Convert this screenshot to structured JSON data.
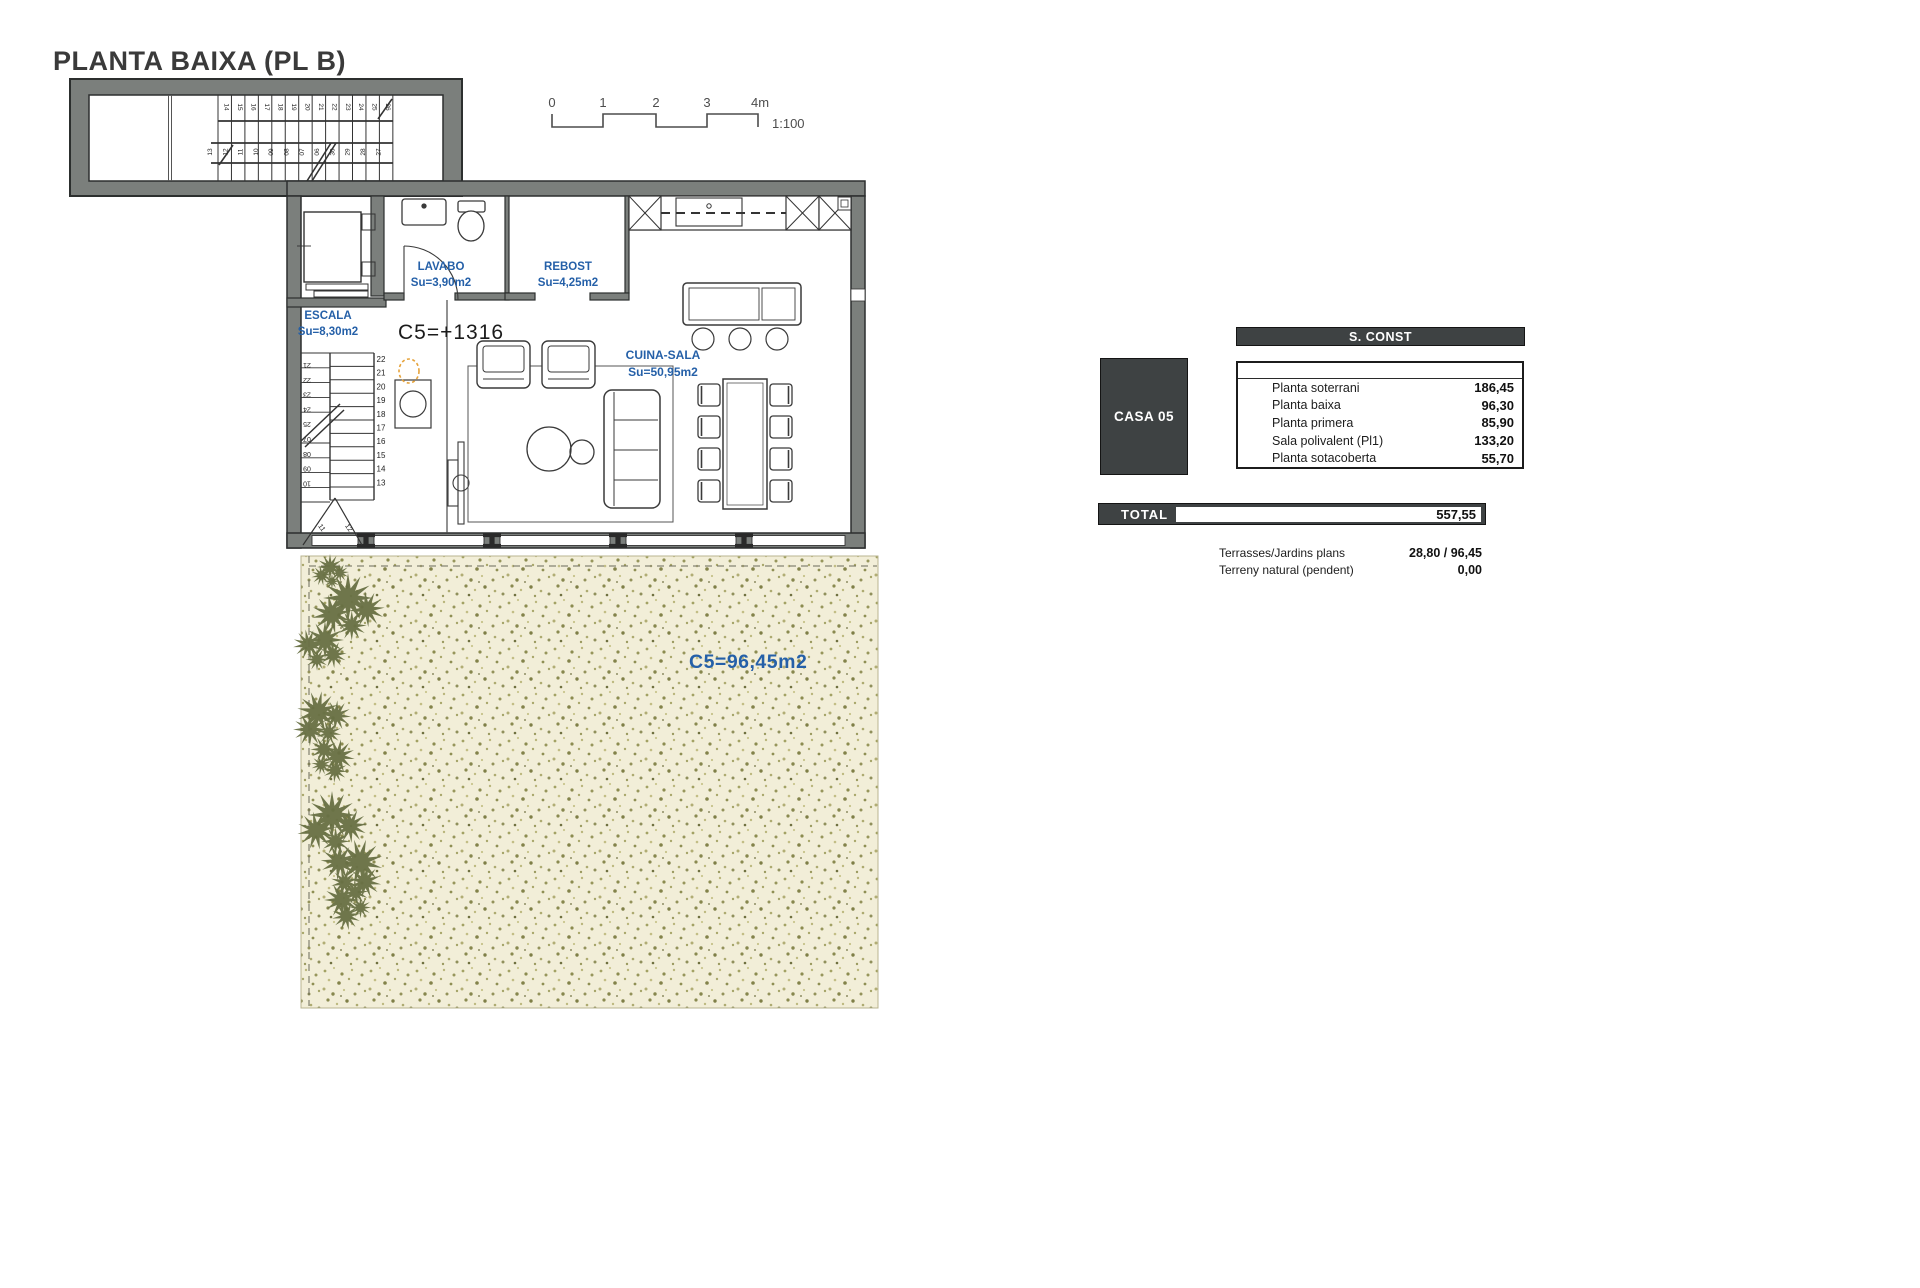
{
  "title": "PLANTA BAIXA (PL B)",
  "scale_bar": {
    "ticks": [
      "0",
      "1",
      "2",
      "3",
      "4m"
    ],
    "ratio_label": "1:100"
  },
  "plan": {
    "level_mark": "C5=+1316",
    "rooms": [
      {
        "name": "LAVABO",
        "area": "Su=3,90m2"
      },
      {
        "name": "REBOST",
        "area": "Su=4,25m2"
      },
      {
        "name": "ESCALA",
        "area": "Su=8,30m2"
      },
      {
        "name": "CUINA-SALA",
        "area": "Su=50,95m2"
      }
    ],
    "garden_area_label": "C5=96,45m2",
    "stair_numbers": {
      "wing_top": [
        "14",
        "15",
        "16",
        "17",
        "18",
        "19",
        "20",
        "21",
        "22",
        "23",
        "24",
        "25",
        "26"
      ],
      "wing_bottom": [
        "13",
        "12",
        "11",
        "10",
        "09",
        "08",
        "07",
        "06",
        "30",
        "29",
        "28",
        "27"
      ],
      "escala_right": [
        "22",
        "21",
        "20",
        "19",
        "18",
        "17",
        "16",
        "15",
        "14",
        "13"
      ],
      "escala_left": [
        "21",
        "22",
        "23",
        "24",
        "25",
        "07",
        "08",
        "09",
        "10"
      ],
      "escala_winders": [
        "11",
        "12"
      ]
    }
  },
  "summary": {
    "casa_label": "CASA 05",
    "table_header": "S. CONST",
    "rows": [
      {
        "label": "Planta soterrani",
        "value": "186,45"
      },
      {
        "label": "Planta baixa",
        "value": "96,30"
      },
      {
        "label": "Planta primera",
        "value": "85,90"
      },
      {
        "label": "Sala polivalent (Pl1)",
        "value": "133,20"
      },
      {
        "label": "Planta sotacoberta",
        "value": "55,70"
      }
    ],
    "total": {
      "label": "TOTAL",
      "value": "557,55"
    },
    "extras": [
      {
        "label": "Terrasses/Jardins plans",
        "value": "28,80 / 96,45"
      },
      {
        "label": "Terreny natural (pendent)",
        "value": "0,00"
      }
    ]
  },
  "colors": {
    "wall_gray": "#7b7f7c",
    "accent_blue": "#2560a8",
    "panel_dark": "#3e4243",
    "garden_base": "#f2eed8"
  }
}
